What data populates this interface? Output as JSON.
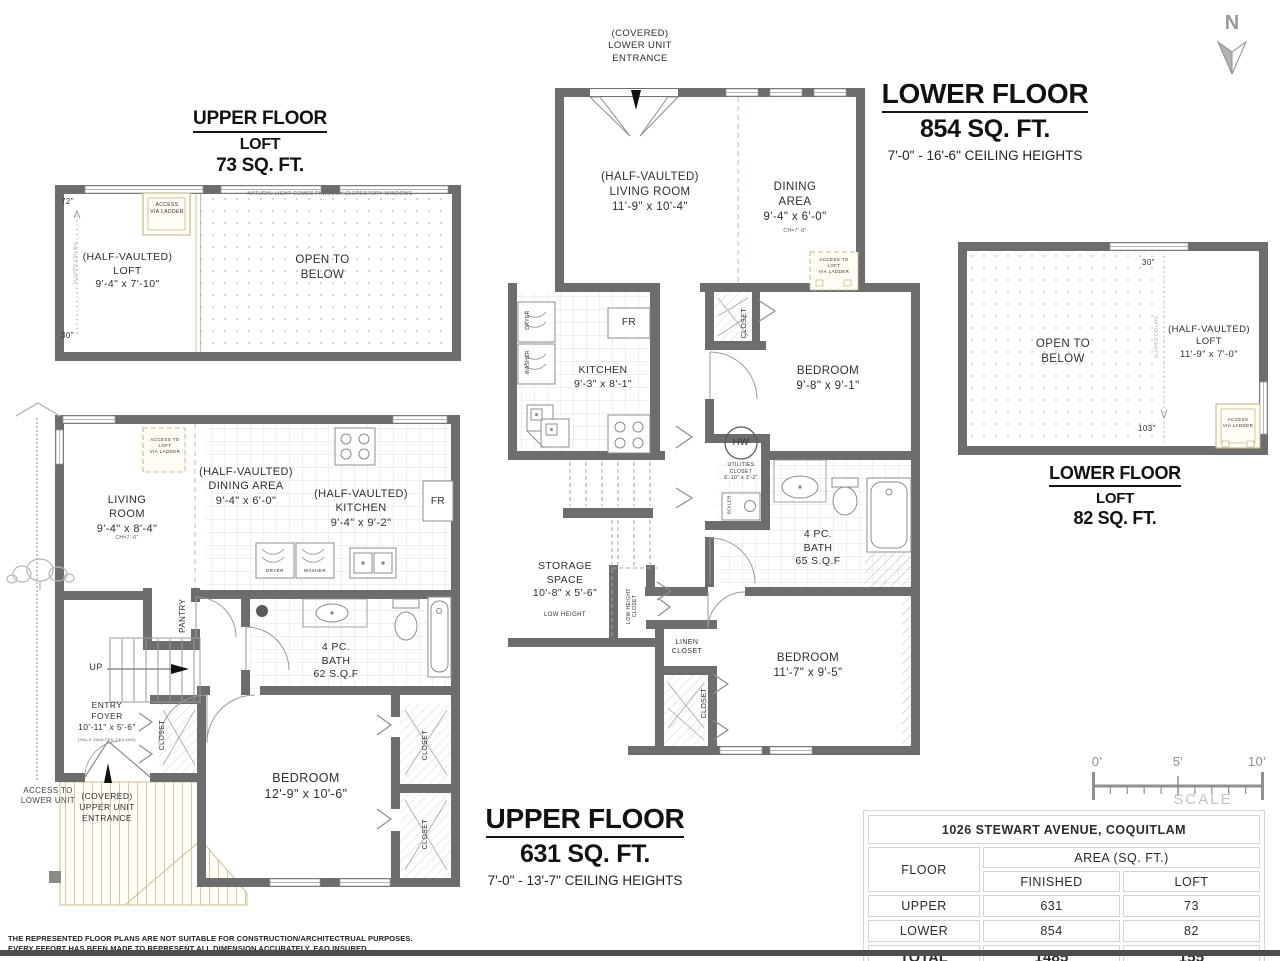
{
  "north": {
    "label": "N"
  },
  "titles": {
    "upper_loft": {
      "line1": "UPPER FLOOR",
      "line2": "LOFT",
      "line3": "73 SQ. FT."
    },
    "lower_floor": {
      "line1": "LOWER FLOOR",
      "line2": "854 SQ. FT.",
      "line3": "7'-0\" - 16'-6\" CEILING HEIGHTS"
    },
    "upper_floor": {
      "line1": "UPPER FLOOR",
      "line2": "631 SQ. FT.",
      "line3": "7'-0\" - 13'-7\" CEILING HEIGHTS"
    },
    "lower_loft": {
      "line1": "LOWER FLOOR",
      "line2": "LOFT",
      "line3": "82 SQ. FT."
    }
  },
  "plan_upper_loft": {
    "clerestory": "NATURAL LIGHT COMES THROUGH CLERESTORY WINDOWS",
    "dim_top": "72\"",
    "dim_bottom": "30\"",
    "sloped_ceiling": "SLOPED CEILING",
    "access_ladder": "ACCESS\nVIA LADDER",
    "loft": "(HALF-VAULTED)\nLOFT\n9'-4\" x 7'-10\"",
    "open_below": "OPEN TO\nBELOW"
  },
  "plan_lower_floor": {
    "entrance": "(COVERED)\nLOWER UNIT\nENTRANCE",
    "living": "(HALF-VAULTED)\nLIVING ROOM\n11'-9\" x 10'-4\"",
    "dining": "DINING\nAREA\n9'-4\" x 6'-0\"",
    "dining_ch": "CH=7'-0\"",
    "access_loft": "ACCESS TO\nLOFT\nVIA LADDER",
    "dryer": "DRYER",
    "washer": "WASHER",
    "fridge": "FR",
    "kitchen": "KITCHEN\n9'-3\" x 8'-1\"",
    "closet": "CLOSET",
    "bedroom1": "BEDROOM\n9'-8\" x 9'-1\"",
    "hot_water": "HW",
    "utilities": "UTILITIES\nCLOSET\n6'-10\" x 3'-2\"",
    "boiler": "BOILER",
    "bath": "4 PC.\nBATH\n65 S.Q.F",
    "storage": "STORAGE\nSPACE\n10'-8\" x 5'-6\"",
    "storage_sub": "LOW HEIGHT",
    "low_height_closet": "LOW HEIGHT\nCLOSET",
    "linen_closet": "LINEN\nCLOSET",
    "closet2": "CLOSET",
    "bedroom2": "BEDROOM\n11'-7\" x 9'-5\""
  },
  "plan_upper_floor": {
    "access_loft": "ACCESS TO\nLOFT\nVIA LADDER",
    "living": "LIVING\nROOM\n9'-4\" x 8'-4\"",
    "living_ch": "CH=7'-0\"",
    "dining": "(HALF-VAULTED)\nDINING AREA\n9'-4\" x 6'-0\"",
    "kitchen": "(HALF-VAULTED)\nKITCHEN\n9'-4\" x 9'-2\"",
    "fridge": "FR",
    "dryer": "DRYER",
    "washer": "WASHER",
    "pantry": "PANTRY",
    "up": "UP",
    "bath": "4 PC.\nBATH\n62 S.Q.F",
    "entry": "ENTRY\nFOYER\n10'-11\" x 5'-6\"",
    "entry_sub": "(HALF-VAULTED CEILING)",
    "closet_foyer": "CLOSET",
    "bedroom": "BEDROOM\n12'-9\" x 10'-6\"",
    "closet1": "CLOSET",
    "closet2": "CLOSET",
    "entrance": "(COVERED)\nUPPER UNIT\nENTRANCE",
    "access_lower": "ACCESS TO\nLOWER UNIT"
  },
  "plan_lower_loft": {
    "open_below": "OPEN TO\nBELOW",
    "dim_top": "30\"",
    "dim_bottom": "103\"",
    "sloped_ceiling": "SLOPED CEILING",
    "loft": "(HALF-VAULTED)\nLOFT\n11'-9\" x 7'-0\"",
    "access_ladder": "ACCESS\nVIA LADDER"
  },
  "scale_bar": {
    "tick0": "0'",
    "tick5": "5'",
    "tick10": "10'",
    "label": "SCALE"
  },
  "summary_table": {
    "address": "1026 STEWART AVENUE, COQUITLAM",
    "floor_header": "FLOOR",
    "area_header": "AREA (SQ. FT.)",
    "finished_header": "FINISHED",
    "loft_header": "LOFT",
    "rows": [
      {
        "floor": "UPPER",
        "finished": "631",
        "loft": "73"
      },
      {
        "floor": "LOWER",
        "finished": "854",
        "loft": "82"
      }
    ],
    "total": {
      "floor": "TOTAL",
      "finished": "1485",
      "loft": "155"
    }
  },
  "disclaimer": {
    "line1": "THE REPRESENTED FLOOR PLANS ARE NOT SUITABLE FOR CONSTRUCTION/ARCHITECTRUAL PURPOSES.",
    "line2": "EVERY EFFORT HAS BEEN MADE TO REPRESENT ALL DIMENSION ACCURATELY.",
    "insured": "E&O INSURED."
  }
}
